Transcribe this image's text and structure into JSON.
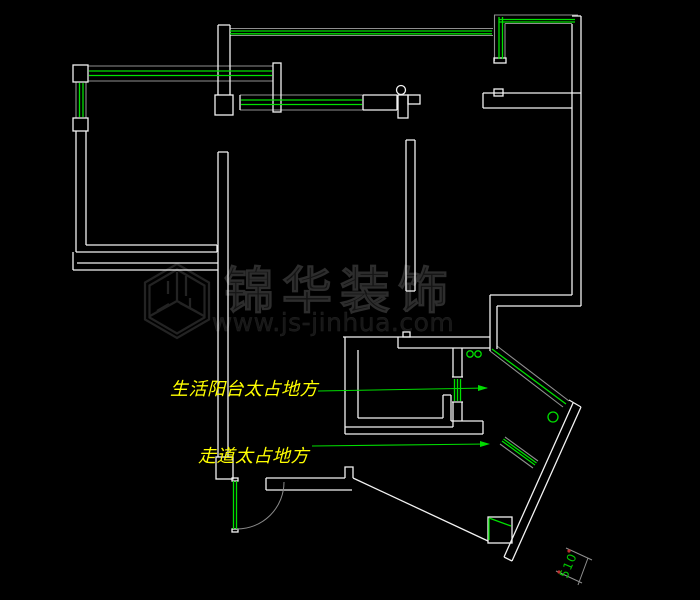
{
  "title": "apartment-floorplan-cad-drawing",
  "watermark": {
    "brand": "锦华装饰",
    "url": "www.js-jinhua.com",
    "logo": "hexagon-cube-logo"
  },
  "annotations": {
    "balcony_note": "生活阳台太占地方",
    "walkway_note": "走道太占地方"
  },
  "dimension": {
    "value": "510"
  },
  "colors": {
    "background": "#000000",
    "wall": "#f2f2f2",
    "window_green": "#00e000",
    "window_rail_gray": "#8f8f8f",
    "annotation_yellow": "#ffff00",
    "dimension_green": "#00c800",
    "dimension_tick_red": "#c03030",
    "watermark_gray": "#1a1a1a"
  }
}
